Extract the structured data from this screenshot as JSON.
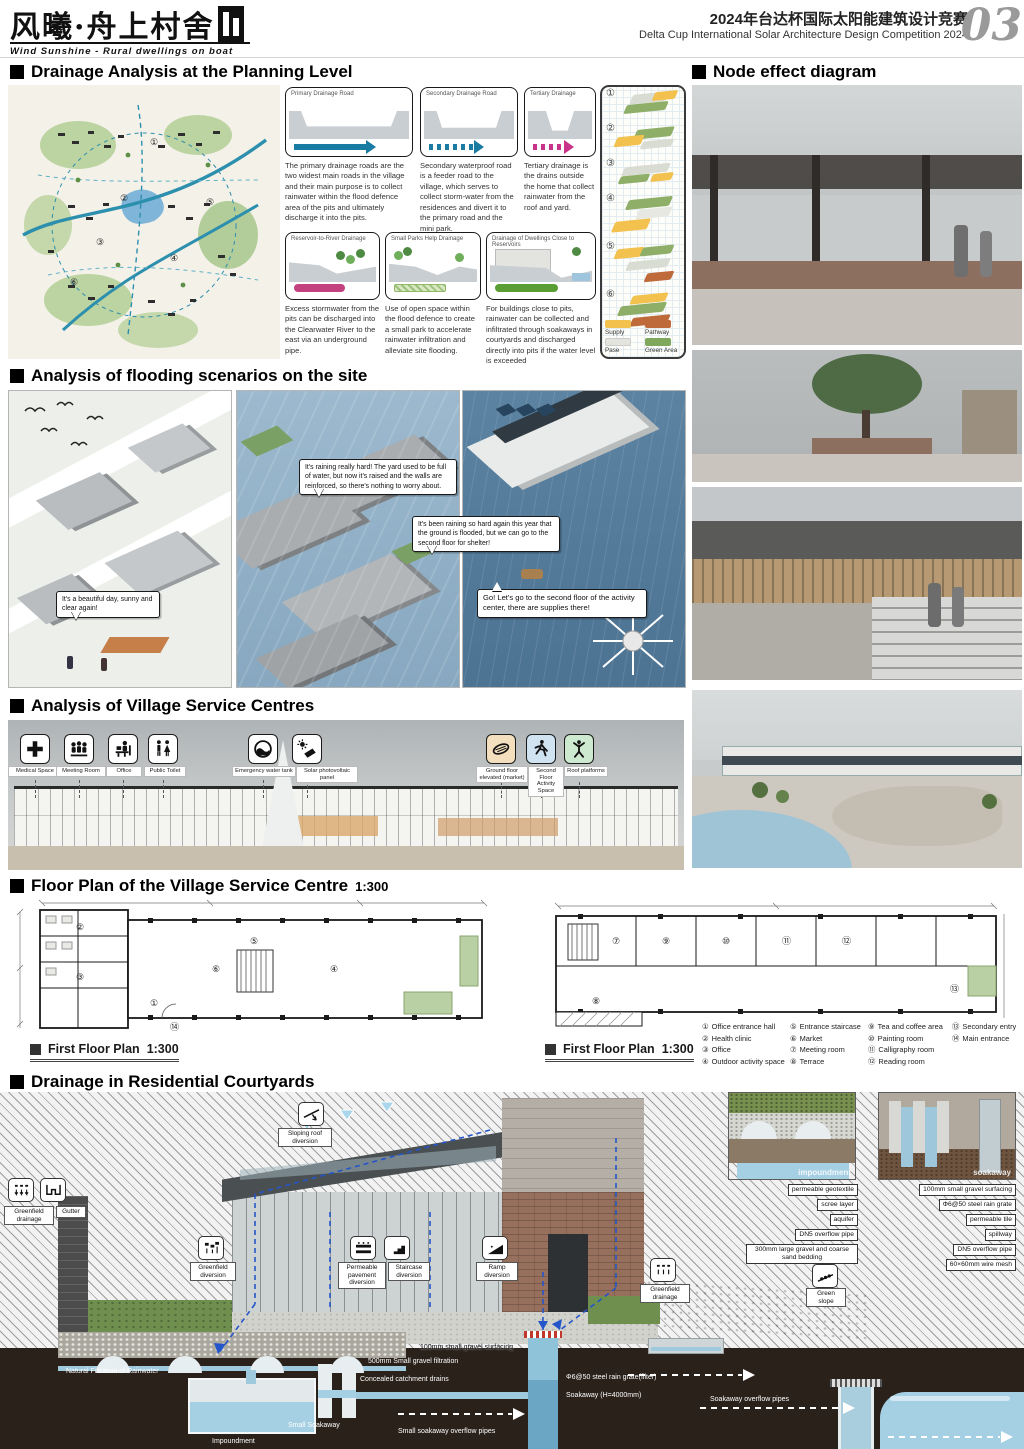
{
  "header": {
    "logo_cn": "风曦·舟上村舍",
    "logo_en": "Wind Sunshine - Rural dwellings on boat",
    "comp_cn": "2024年台达杯国际太阳能建筑设计竞赛",
    "comp_en": "Delta Cup International Solar Architecture Design Competition 2024",
    "page_no": "03"
  },
  "drainage": {
    "title": "Drainage Analysis at the Planning Level",
    "cards": [
      {
        "title": "Primary Drainage Road",
        "text": "The primary drainage roads are the two widest main roads in the village and their main purpose is to collect rainwater within the flood defence area of the pits and ultimately discharge it into the pits."
      },
      {
        "title": "Secondary Drainage Road",
        "text": "Secondary waterproof road is a feeder road to the village, which serves to collect storm-water from the residences and divert it to the primary road and the mini park."
      },
      {
        "title": "Tertiary Drainage",
        "text": "Tertiary drainage is the drains outside the home that collect rainwater from the roof and yard."
      },
      {
        "title": "Reservoir-to-River Drainage",
        "text": "Excess stormwater from the pits can be discharged into the Clearwater River to the east via an underground pipe."
      },
      {
        "title": "Small Parks Help Drainage",
        "text": "Use of open space within the flood defence to create a small park to accelerate rainwater infiltration and alleviate site flooding."
      },
      {
        "title": "Drainage of Dwellings Close to Reservoirs",
        "text": "For buildings close to pits, rainwater can be collected and infiltrated through soakaways in courtyards and discharged directly into pits if the water level is exceeded"
      }
    ],
    "strip_numbers": [
      "①",
      "②",
      "③",
      "④",
      "⑤",
      "⑥"
    ],
    "legend": [
      {
        "label": "Supply",
        "color": "#f2c14e"
      },
      {
        "label": "Pathway",
        "color": "#bf6a3a"
      },
      {
        "label": "Pase",
        "color": "#e4e4df"
      },
      {
        "label": "Green Area",
        "color": "#7fa85c"
      }
    ]
  },
  "node": {
    "title": "Node effect diagram"
  },
  "flooding": {
    "title": "Analysis of flooding scenarios on the site",
    "bubbles": [
      "It's a beautiful day, sunny and clear again!",
      "It's raining really hard! The yard used to be full of water, but now it's raised and the walls are reinforced, so there's nothing to worry about.",
      "It's been raining so hard again this year that the ground is flooded, but we can go to the second floor for shelter!",
      "Go! Let's go to the second floor of the activity center, there are supplies there!"
    ]
  },
  "service": {
    "title": "Analysis of Village Service Centres",
    "icons": [
      "Medical Space",
      "Meeting Room",
      "Office",
      "Public Toilet",
      "Emergency water tank",
      "Solar photovoltaic panel",
      "Ground floor elevated (market)",
      "Second Floor Activity Space",
      "Roof platforms"
    ]
  },
  "floorplan": {
    "title": "Floor Plan of the Village Service Centre",
    "scale": "1:300",
    "left_label": "First Floor Plan",
    "left_scale": "1:300",
    "right_label": "First Floor Plan",
    "right_scale": "1:300",
    "legend": [
      {
        "num": "①",
        "label": "Office entrance hall"
      },
      {
        "num": "②",
        "label": "Health clinic"
      },
      {
        "num": "③",
        "label": "Office"
      },
      {
        "num": "④",
        "label": "Outdoor activity space"
      },
      {
        "num": "⑤",
        "label": "Entrance staircase"
      },
      {
        "num": "⑥",
        "label": "Market"
      },
      {
        "num": "⑦",
        "label": "Meeting room"
      },
      {
        "num": "⑧",
        "label": "Terrace"
      },
      {
        "num": "⑨",
        "label": "Tea and coffee area"
      },
      {
        "num": "⑩",
        "label": "Painting room"
      },
      {
        "num": "⑪",
        "label": "Calligraphy room"
      },
      {
        "num": "⑫",
        "label": "Reading room"
      },
      {
        "num": "⑬",
        "label": "Secondary entry"
      },
      {
        "num": "⑭",
        "label": "Main entrance"
      }
    ]
  },
  "courtyards": {
    "title": "Drainage in Residential Courtyards",
    "labels": {
      "sloping_roof": "Sloping roof diversion",
      "greenfield_drainage_l": "Greenfield drainage",
      "gutter": "Gutter",
      "greenfield_diversion": "Greenfield diversion",
      "permeable": "Permeable pavement diversion",
      "staircase": "Staircase diversion",
      "ramp": "Ramp diversion",
      "natural_filtration": "Natural Filtration of Rainwater",
      "impoundment": "Impoundment",
      "small_soakaway": "Small Soakaway",
      "concealed_drains": "Concealed catchment drains",
      "gravel_filtration_500": "500mm Small gravel filtration",
      "gravel_surfacing_100": "100mm small gravel surfacing",
      "rain_grate_filter": "Φ6@50 steel rain grate(filter)",
      "soakaway_h": "Soakaway (H=4000mm)",
      "small_overflow_pipes": "Small soakaway overflow pipes",
      "overflow_pipes": "Soakaway overflow pipes",
      "greenfield_drainage_r": "Greenfield drainage",
      "green_slope": "Green slope"
    },
    "inset_left": {
      "caption": "impoundment",
      "items": [
        "permeable geotextile",
        "scree layer",
        "aquifer",
        "DN5 overflow pipe",
        "300mm large gravel and coarse sand bedding"
      ]
    },
    "inset_right": {
      "caption": "soakaway",
      "items": [
        "100mm small gravel surfacing",
        "Φ6@50 steel rain grate",
        "permeable tile",
        "spillway",
        "DN5 overflow pipe",
        "60×60mm wire mesh"
      ]
    }
  }
}
